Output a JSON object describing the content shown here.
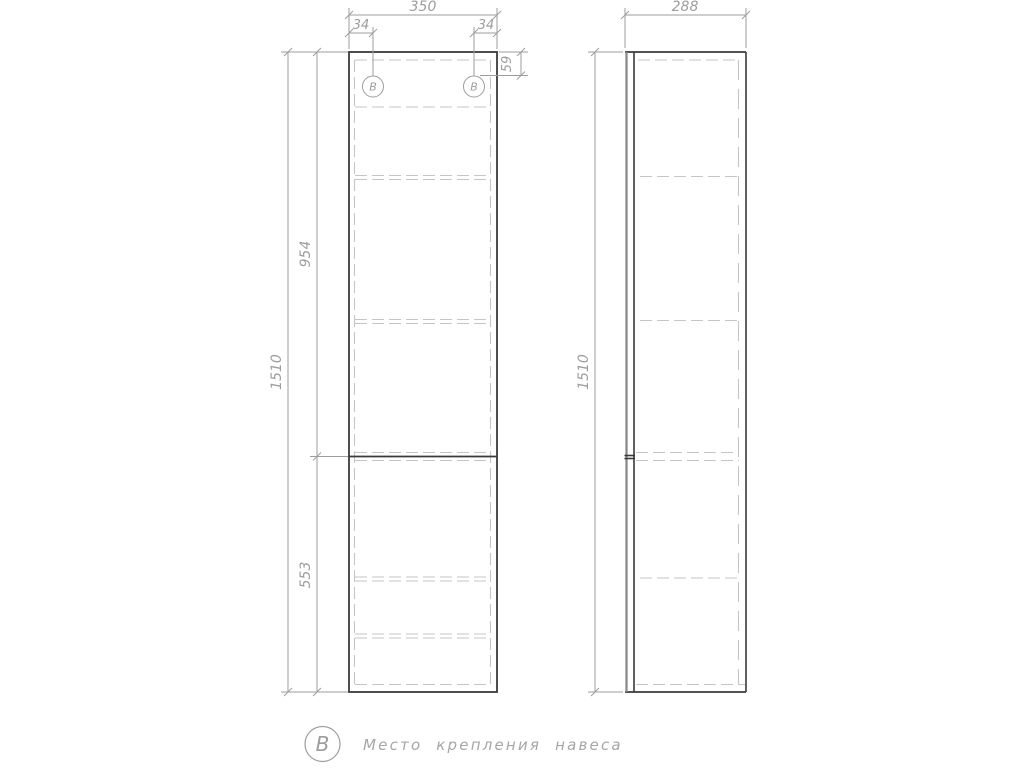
{
  "colors": {
    "background": "#ffffff",
    "outline": "#3a3a3a",
    "panel_edge": "#858585",
    "hidden": "#c5c5c5",
    "dimension": "#9d9d9d",
    "legend_text": "#a6a6a6"
  },
  "front_view": {
    "dims": {
      "width": "350",
      "hole_left": "34",
      "hole_right": "34",
      "hole_top": "59",
      "upper": "954",
      "total": "1510",
      "lower": "553"
    },
    "markers": [
      {
        "label": "В"
      },
      {
        "label": "В"
      }
    ]
  },
  "side_view": {
    "dims": {
      "depth": "288",
      "total": "1510"
    }
  },
  "legend": {
    "symbol": "В",
    "text": "Место крепления навеса"
  }
}
